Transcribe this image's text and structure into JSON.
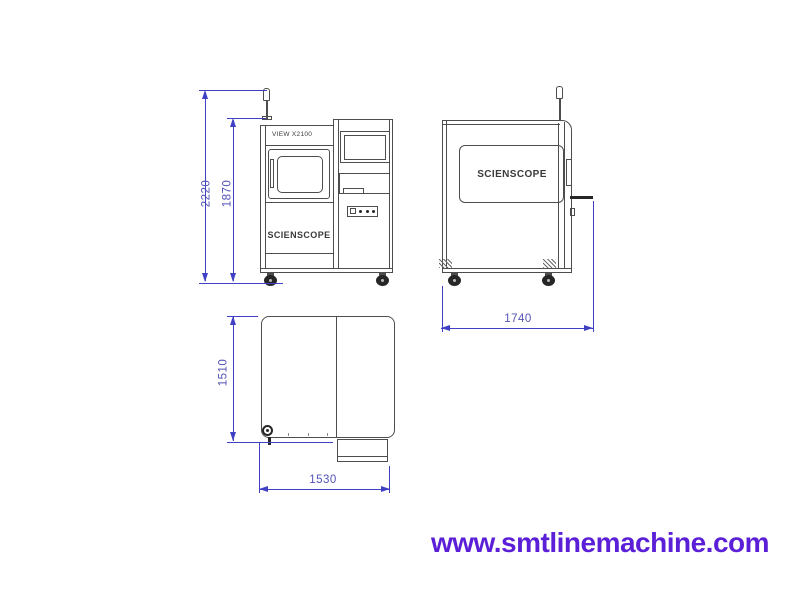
{
  "diagram": {
    "machine_model": "VIEW X2100",
    "brand_logo": "SCIENSCOPE",
    "dimensions": {
      "overall_height_mm": "2220",
      "cabinet_height_mm": "1870",
      "side_width_mm": "1740",
      "top_depth_mm": "1510",
      "top_width_mm": "1530"
    },
    "colors": {
      "line": "#4d4d4d",
      "dimension": "#4040c4",
      "dimension_text": "#5353b8",
      "website_text": "#5a1fd6"
    }
  },
  "footer": {
    "website_url": "www.smtlinemachine.com"
  }
}
